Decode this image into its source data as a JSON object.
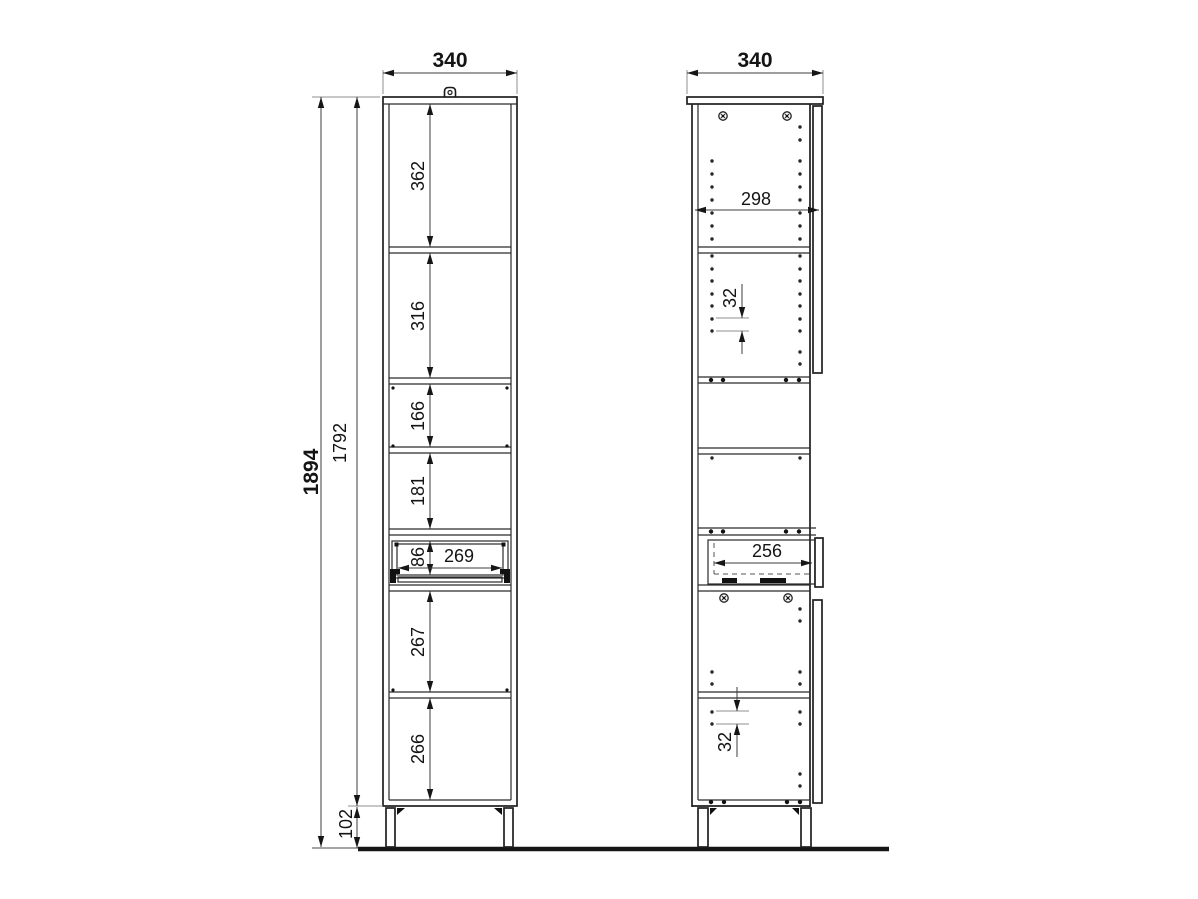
{
  "drawing": {
    "front_view": {
      "width_mm": "340",
      "overall_height_mm": "1894",
      "carcass_height_mm": "1792",
      "plinth_height_mm": "102",
      "compartments": {
        "c1": "362",
        "c2": "316",
        "c3": "166",
        "c4": "181",
        "c5": "267",
        "c6": "266"
      },
      "drawer": {
        "front_height_mm": "86",
        "inner_width_mm": "269"
      }
    },
    "side_view": {
      "depth_mm": "340",
      "interior_depth_mm": "298",
      "hole_pitch_upper_mm": "32",
      "drawer_depth_mm": "256",
      "hole_pitch_lower_mm": "32"
    }
  }
}
